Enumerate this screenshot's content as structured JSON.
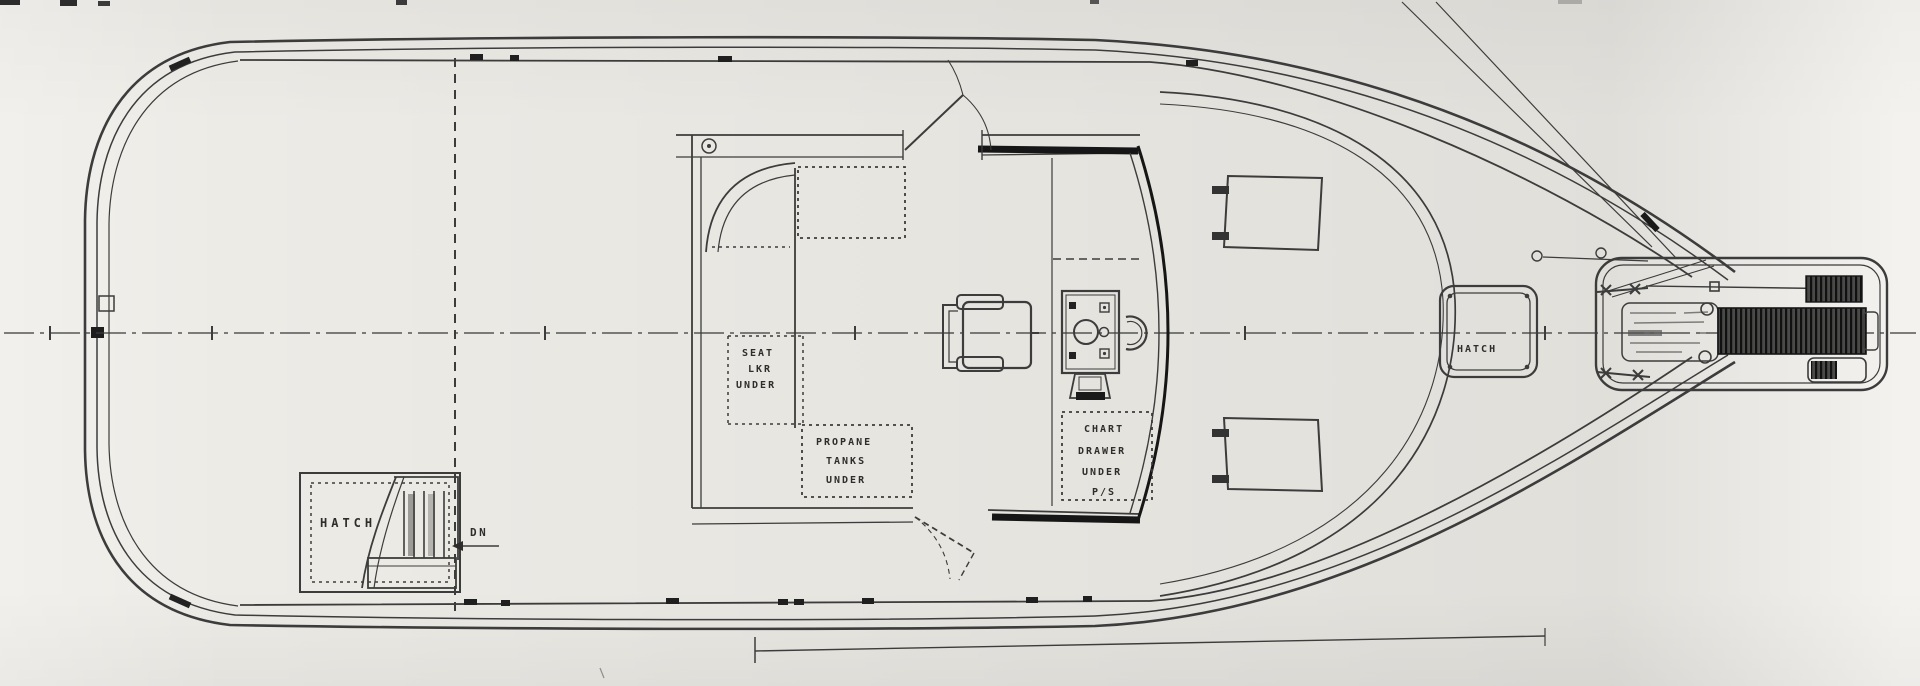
{
  "drawing": {
    "kind": "boat deck plan line drawing, scanned",
    "labels": {
      "aft_deck_hatch": "HATCH",
      "companionway_down": "DN",
      "seat_locker": [
        "SEAT",
        "LKR",
        "UNDER"
      ],
      "propane_locker": [
        "PROPANE",
        "TANKS",
        "UNDER"
      ],
      "chart_drawer": [
        "CHART",
        "DRAWER",
        "UNDER",
        "P/S"
      ],
      "foredeck_hatch": "HATCH"
    },
    "colors": {
      "paper": "#edebe6",
      "ink": "#3c3c3c",
      "ink_heavy": "#161616",
      "faded_ink": "#9a9a98"
    }
  }
}
